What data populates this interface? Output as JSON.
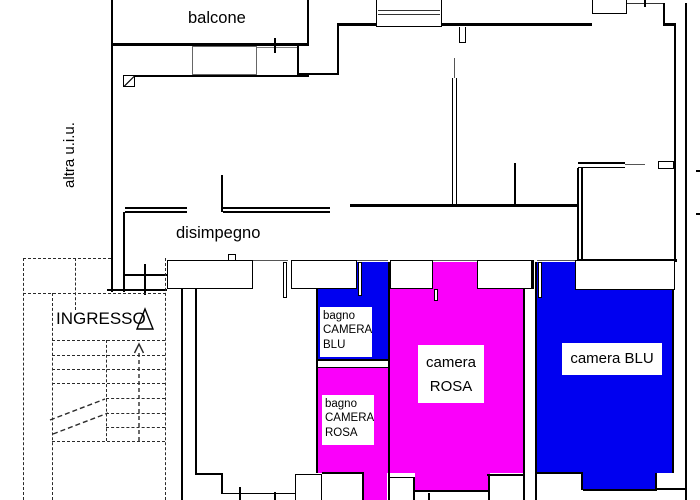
{
  "plan": {
    "type": "apartment floor plan",
    "rooms": {
      "balcone": {
        "label": "balcone"
      },
      "altra_uiu": {
        "label": "altra u.i.u."
      },
      "disimpegno": {
        "label": "disimpegno"
      },
      "ingresso": {
        "label": "INGRESSO"
      },
      "bagno_camera_blu": {
        "line1": "bagno",
        "line2": "CAMERA",
        "line3": "BLU"
      },
      "bagno_camera_rosa": {
        "line1": "bagno",
        "line2": "CAMERA",
        "line3": "ROSA"
      },
      "camera_rosa": {
        "line1": "camera",
        "line2": "ROSA"
      },
      "camera_blu": {
        "label": "camera BLU"
      }
    },
    "colors": {
      "blu_fill": "#0000f0",
      "rosa_fill": "#fa00fa"
    }
  }
}
